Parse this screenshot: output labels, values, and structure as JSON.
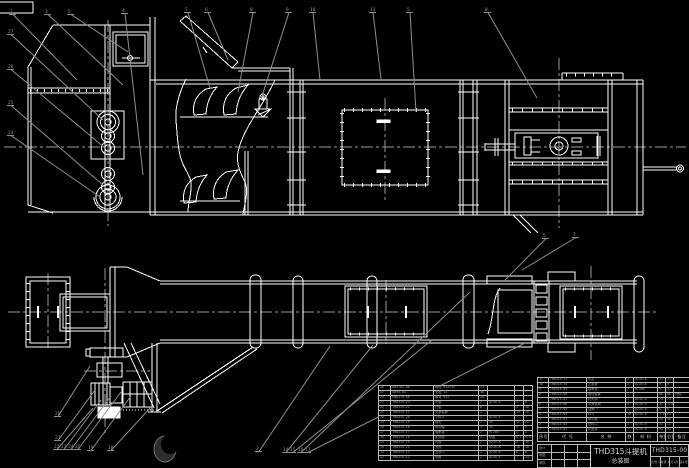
{
  "sheet": {
    "background": "#000000",
    "line_color": "#ffffff",
    "leader_color": "#8f8f8f",
    "centerline_color": "#9a9a9a"
  },
  "title_block": {
    "product": "THD315斗提机",
    "drawing_type": "总装图",
    "drawing_no": "THD315-00",
    "info_cells": [
      "比例 1:10",
      "数量 1",
      "共1张",
      "第1张"
    ],
    "sig_rows": [
      [
        "设计",
        "",
        "",
        ""
      ],
      [
        "制图",
        "",
        "",
        ""
      ],
      [
        "审核",
        "",
        "",
        ""
      ]
    ]
  },
  "bom_right": {
    "header": [
      "序号",
      "代  号",
      "名  称",
      "数",
      "材  料",
      "单重",
      "总重",
      "备注"
    ],
    "rows": [
      [
        "11",
        "THD315-11",
        "机罩",
        "1",
        "Q235-A",
        "13",
        "13",
        ""
      ],
      [
        "10",
        "THD315-10",
        "上盖板",
        "1",
        "Q235-A",
        "9",
        "9",
        ""
      ],
      [
        "9",
        "THD315-09",
        "轴承座",
        "2",
        "HT200",
        "6",
        "12",
        ""
      ],
      [
        "8",
        "THD315-08",
        "驱动装置",
        "1",
        "",
        "86",
        "86",
        "外购"
      ],
      [
        "7",
        "THD315-07",
        "机头部",
        "1",
        "Q235-A",
        "74",
        "74",
        ""
      ],
      [
        "6",
        "THD315-06",
        "中间机筒",
        "4",
        "Q235-A",
        "31",
        "124",
        ""
      ],
      [
        "5",
        "THD315-05",
        "观察门",
        "1",
        "Q235-A",
        "8",
        "8",
        ""
      ],
      [
        "4",
        "THD315-04",
        "料斗",
        "38",
        "Q235-A",
        "1.6",
        "61",
        ""
      ],
      [
        "3",
        "THD315-03",
        "牵引链",
        "2",
        "",
        "24",
        "48",
        ""
      ],
      [
        "2",
        "THD315-02",
        "进料口",
        "1",
        "Q235-A",
        "11",
        "11",
        ""
      ],
      [
        "1",
        "THD315-01",
        "机座部",
        "1",
        "Q235-A",
        "92",
        "92",
        ""
      ]
    ]
  },
  "bom_left": {
    "rows": [
      [
        "26",
        "GB5782-86",
        "螺栓 M12×45",
        "24",
        "",
        "",
        ""
      ],
      [
        "25",
        "GB95-85",
        "垫圈 12",
        "48",
        "",
        "",
        ""
      ],
      [
        "24",
        "GB6170-86",
        "螺母 M12",
        "24",
        "",
        "",
        ""
      ],
      [
        "23",
        "THD315-23",
        "护板",
        "2",
        "Q235-A",
        "4",
        "8"
      ],
      [
        "22",
        "THD315-22",
        "托辊",
        "6",
        "",
        "3",
        "18"
      ],
      [
        "21",
        "THD315-21",
        "张紧装置",
        "1",
        "",
        "15",
        "15"
      ],
      [
        "20",
        "THD315-20",
        "下料斗",
        "1",
        "Q235-A",
        "7",
        "7"
      ],
      [
        "19",
        "THD315-19",
        "链轮",
        "2",
        "45",
        "11",
        "22"
      ],
      [
        "18",
        "THD315-18",
        "传动轴",
        "1",
        "45",
        "9",
        "9"
      ],
      [
        "17",
        "THD315-17",
        "轴承盖",
        "2",
        "HT200",
        "2",
        "4"
      ],
      [
        "16",
        "THD315-16",
        "密封圈",
        "4",
        "橡胶",
        "0.1",
        "0.4"
      ],
      [
        "15",
        "THD315-15",
        "衬板",
        "2",
        "Q235-A",
        "5",
        "10"
      ],
      [
        "14",
        "THD315-14",
        "底座",
        "1",
        "Q235-A",
        "18",
        "18"
      ],
      [
        "13",
        "THD315-13",
        "出料口",
        "1",
        "Q235-A",
        "6",
        "6"
      ],
      [
        "12",
        "THD315-12",
        "侧板",
        "2",
        "Q235-A",
        "7",
        "14"
      ]
    ]
  },
  "balloons": {
    "top": [
      "2",
      "3",
      "5",
      "4",
      "7",
      "6",
      "8",
      "9",
      "10",
      "11",
      "5",
      "8"
    ],
    "left": [
      "27",
      "26",
      "25",
      "24"
    ],
    "mid": [
      "5",
      "7"
    ],
    "bottom": [
      "20",
      "21",
      "22",
      "23",
      "24",
      "25",
      "19",
      "18",
      "3",
      "14",
      "15",
      "16",
      "17"
    ]
  }
}
